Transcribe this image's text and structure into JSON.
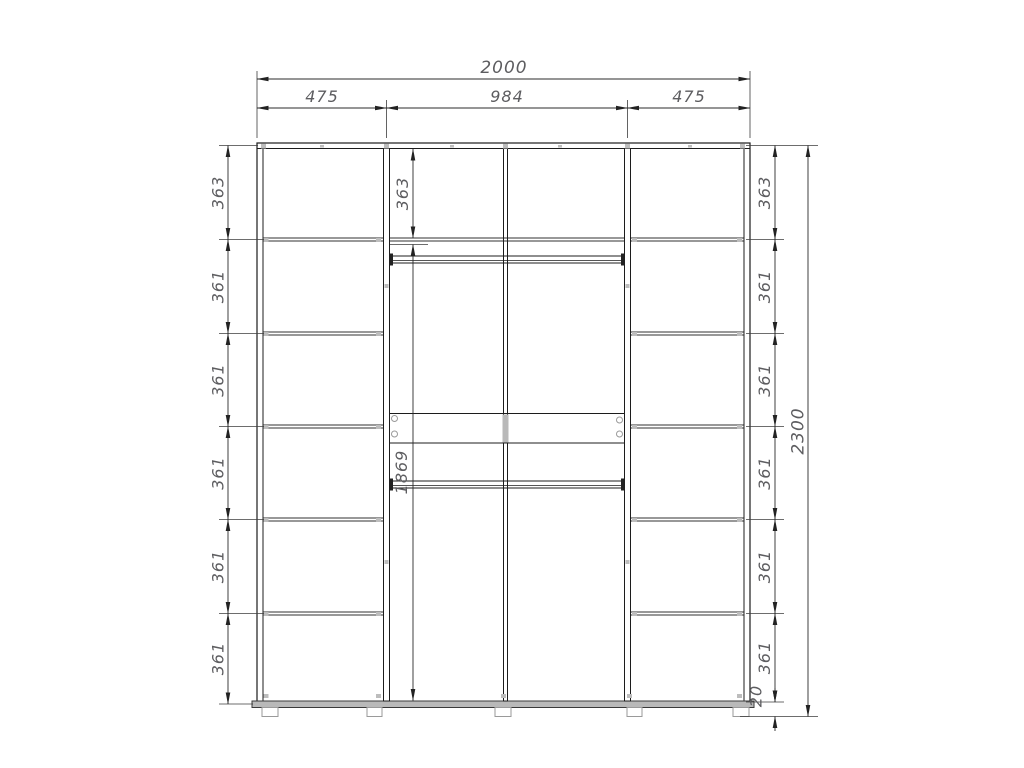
{
  "drawing": {
    "title": "Wardrobe front elevation with dimensions",
    "units": "mm",
    "top": {
      "overall": "2000",
      "sections": [
        "475",
        "984",
        "475"
      ]
    },
    "left_column": [
      "363",
      "361",
      "361",
      "361",
      "361",
      "361"
    ],
    "middle_column": {
      "upper": "363",
      "lower": "1869"
    },
    "right_column": [
      "363",
      "361",
      "361",
      "361",
      "361",
      "361"
    ],
    "side": {
      "overall_height": "2300",
      "plinth": "20"
    }
  }
}
